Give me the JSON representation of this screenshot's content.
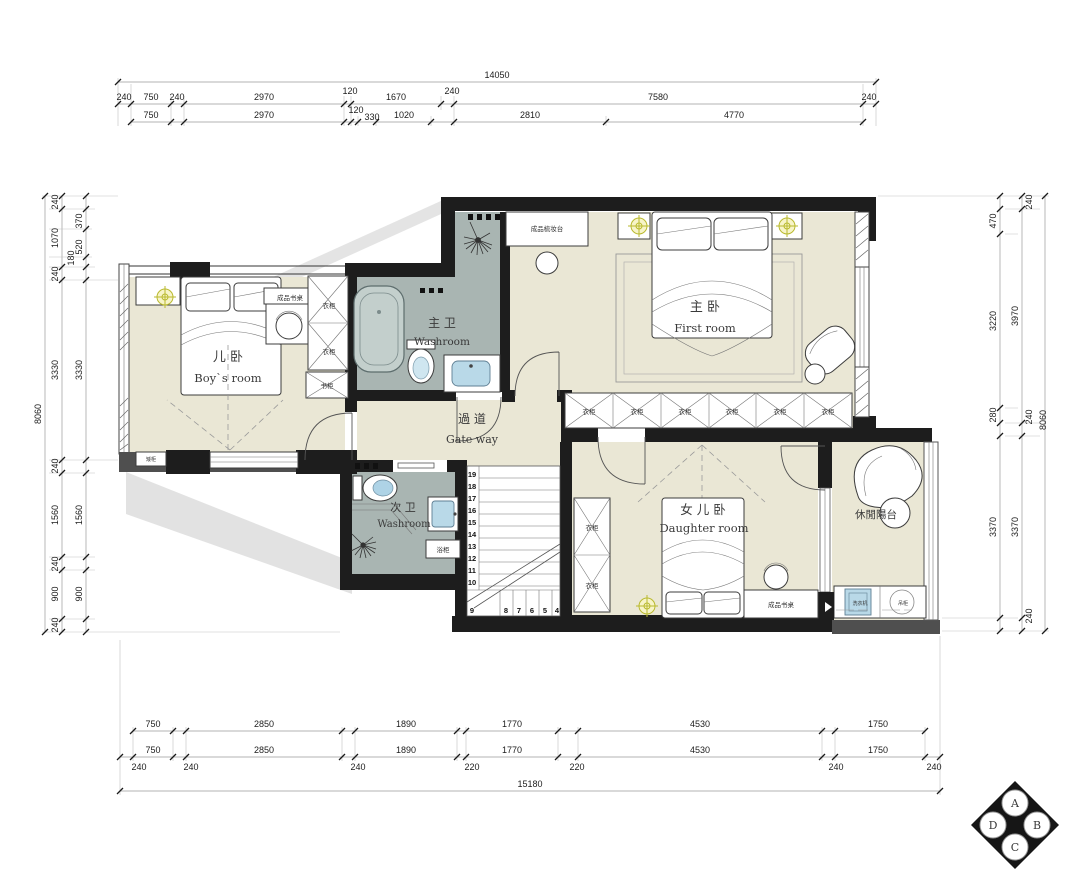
{
  "rooms": {
    "boys": {
      "zh": "儿 卧",
      "en": "Boy`s room"
    },
    "master_bath": {
      "zh": "主 卫",
      "en": "Washroom"
    },
    "master": {
      "zh": "主 卧",
      "en": "First room"
    },
    "hall": {
      "zh": "過 道",
      "en": "Gate way"
    },
    "second_bath": {
      "zh": "次 卫",
      "en": "Washroom"
    },
    "daughter": {
      "zh": "女 儿 卧",
      "en": "Daughter room"
    },
    "balcony": {
      "zh": "休閒陽台"
    }
  },
  "labels": {
    "desk": "成品书桌",
    "dresser": "成品梳妆台",
    "wardrobe": "衣柜",
    "bookcase": "书柜",
    "bath_cabinet": "浴柜",
    "low_cabinet": "矮柜",
    "washer": "洗衣机",
    "hanging_cabinet": "吊柜"
  },
  "dims": {
    "top": {
      "overall": "14050",
      "row1": [
        "240",
        "750",
        "240",
        "2970",
        "120",
        "1670",
        "240",
        "7580",
        "240"
      ],
      "row2": [
        "750",
        "2970",
        "120",
        "330",
        "1020",
        "2810",
        "4770"
      ]
    },
    "bottom": {
      "overall": "15180",
      "row1": [
        "750",
        "2850",
        "1890",
        "1770",
        "4530",
        "1750"
      ],
      "row2": [
        "750",
        "2850",
        "1890",
        "1770",
        "4530",
        "1750"
      ],
      "walls": [
        "240",
        "240",
        "240",
        "220",
        "220",
        "240",
        "240"
      ]
    },
    "left": {
      "overall": "8060",
      "outer": [
        "240",
        "1070",
        "240",
        "3330",
        "240",
        "1560",
        "240",
        "900",
        "240"
      ],
      "inner": [
        "370",
        "520",
        "180",
        "3330",
        "1560",
        "900"
      ]
    },
    "right": {
      "overall": "8060",
      "inner": [
        "470",
        "3220",
        "280",
        "3370"
      ],
      "outer": [
        "240",
        "3970",
        "240",
        "3370",
        "240"
      ]
    }
  },
  "stairs": {
    "upper": [
      "19",
      "18",
      "17",
      "16",
      "15",
      "14",
      "13",
      "12",
      "11",
      "10"
    ],
    "lower": [
      "9",
      "8",
      "7",
      "6",
      "5",
      "4"
    ]
  },
  "compass": {
    "top": "A",
    "right": "B",
    "bottom": "C",
    "left": "D"
  },
  "colors": {
    "floor": "#eae7d5",
    "bath_floor": "#a9b5b2",
    "wall": "#1d1d1d",
    "fixture_blue": "#b9d9e8",
    "light_yellow": "#b9b92e"
  }
}
